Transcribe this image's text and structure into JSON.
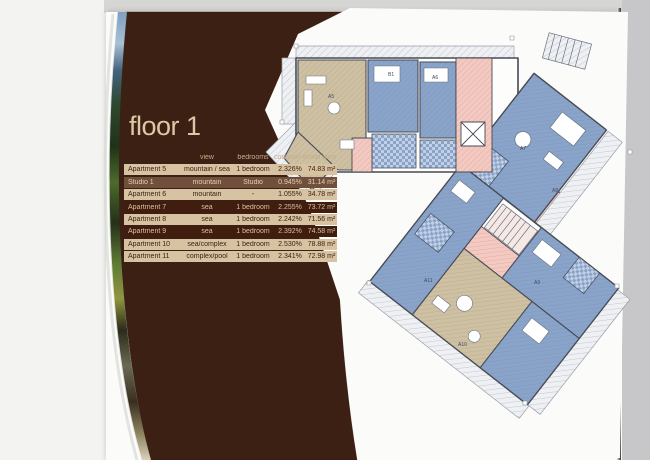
{
  "page": {
    "title": "floor 1",
    "table": {
      "headers": {
        "view": "view",
        "bedrooms": "bedrooms",
        "common": "common area",
        "total": "total area"
      },
      "rows": [
        {
          "name": "Apartment 5",
          "view": "mountain / sea",
          "bedrooms": "1 bedroom",
          "common": "2.326%",
          "total": "74.83 m²",
          "tone": "light"
        },
        {
          "name": "Studio 1",
          "view": "mountain",
          "bedrooms": "Studio",
          "common": "0.945%",
          "total": "31.14 m²",
          "tone": "medium"
        },
        {
          "name": "Apartment 6",
          "view": "mountain",
          "bedrooms": "-",
          "common": "1.055%",
          "total": "34.78 m²",
          "tone": "light"
        },
        {
          "name": "Apartment 7",
          "view": "sea",
          "bedrooms": "1 bedroom",
          "common": "2.255%",
          "total": "73.72 m²",
          "tone": "dark"
        },
        {
          "name": "Apartment 8",
          "view": "sea",
          "bedrooms": "1 bedroom",
          "common": "2.242%",
          "total": "71.56 m²",
          "tone": "light"
        },
        {
          "name": "Apartment 9",
          "view": "sea",
          "bedrooms": "1 bedroom",
          "common": "2.392%",
          "total": "74.58 m²",
          "tone": "dark"
        },
        {
          "name": "Apartment 10",
          "view": "sea/complex",
          "bedrooms": "1 bedroom",
          "common": "2.530%",
          "total": "78.88 m²",
          "tone": "light"
        },
        {
          "name": "Apartment 11",
          "view": "complex/pool",
          "bedrooms": "1 bedroom",
          "common": "2.341%",
          "total": "72.98 m²",
          "tone": "light"
        }
      ]
    },
    "floor_plan": {
      "room_labels": [
        "A5",
        "B1",
        "A6",
        "A7",
        "A8",
        "A9",
        "A10",
        "A11"
      ]
    },
    "colors": {
      "panel_brown": "#3c2013",
      "row_light": "#d7c2a2",
      "row_dark": "#401d0e",
      "plan_room_blue": "#8aa3c9",
      "plan_room_tan": "#cec0a3",
      "plan_corridor_pink": "#f3cac2"
    }
  }
}
